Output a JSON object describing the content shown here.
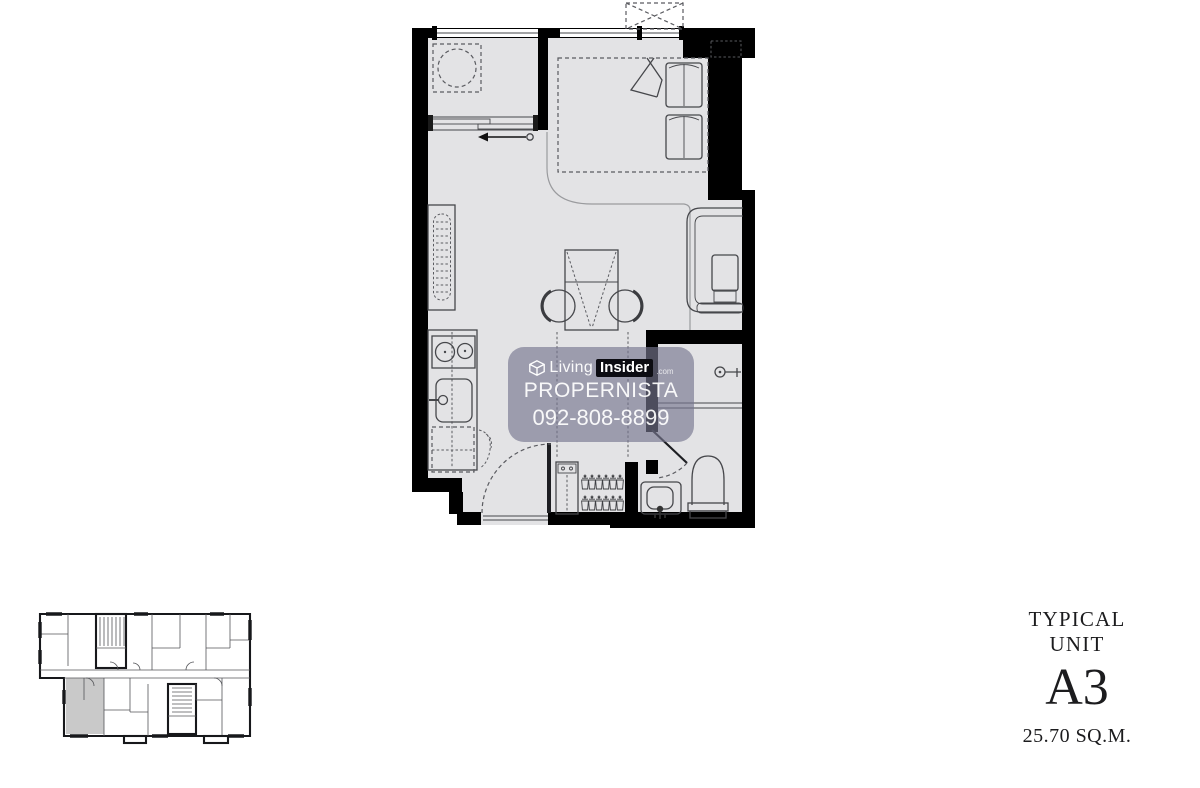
{
  "page": {
    "background": "#ffffff"
  },
  "colors": {
    "wall": "#000000",
    "floor": "#e3e3e5",
    "line": "#46474b",
    "dashed": "#5a5b60",
    "zone": "#9a9b9e",
    "keyplan_wall": "#17181b",
    "keyplan_thin": "#55565a",
    "keyplan_highlight": "#c9c9c9",
    "watermark_bg": "rgba(118,119,143,0.65)",
    "watermark_text": "#ffffff",
    "badge_bg": "#0c0c12",
    "label_text": "#1c1c1e"
  },
  "watermark": {
    "logo": {
      "icon": "livinginsider-cube-icon",
      "living": "Living",
      "insider": "Insider",
      "tld": ".com"
    },
    "agency": "PROPERNISTA",
    "phone": "092-808-8899"
  },
  "unit_label": {
    "title": "TYPICAL UNIT",
    "code": "A3",
    "area": "25.70 SQ.M."
  },
  "floorplan": {
    "furniture_icons": [
      "washing-machine-icon",
      "sliding-door-icon",
      "bed-icon",
      "pillow-icon",
      "ac-condenser-icon",
      "dish-rack-icon",
      "stove-icon",
      "kitchen-sink-icon",
      "refrigerator-icon",
      "dining-table-icon",
      "chair-icon",
      "sofa-icon",
      "wardrobe-icon",
      "clothes-hanger-icon",
      "entry-door-icon",
      "shower-icon",
      "toilet-icon",
      "vanity-sink-icon"
    ],
    "keyplan": {
      "highlighted_unit": "A3"
    }
  }
}
